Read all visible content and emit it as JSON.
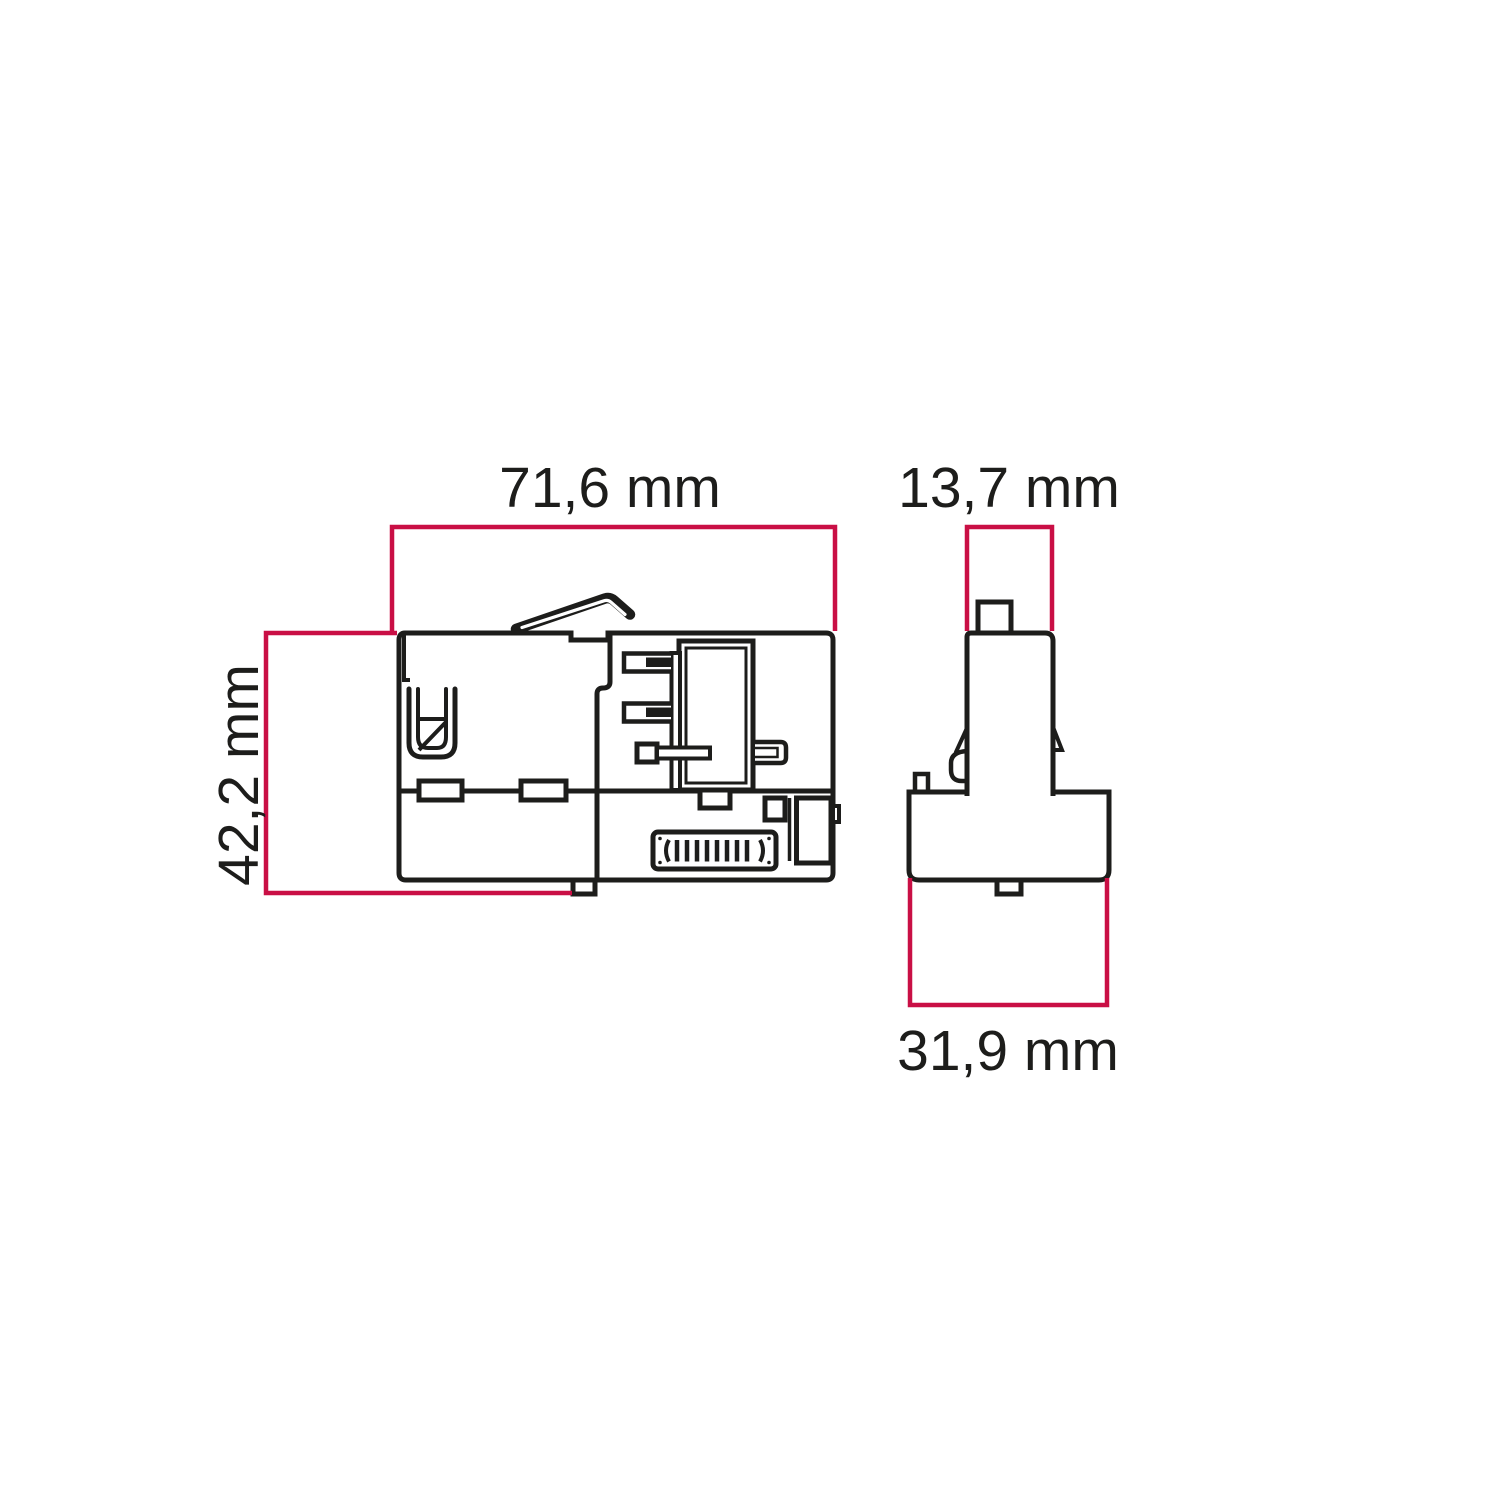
{
  "labels": {
    "side_width": "71,6 mm",
    "side_height": "42,2 mm",
    "front_width": "13,7 mm",
    "front_base_width": "31,9 mm"
  },
  "colors": {
    "dimension_line": "#c90f45",
    "drawing_line": "#1d1d1b",
    "background": "#ffffff"
  }
}
